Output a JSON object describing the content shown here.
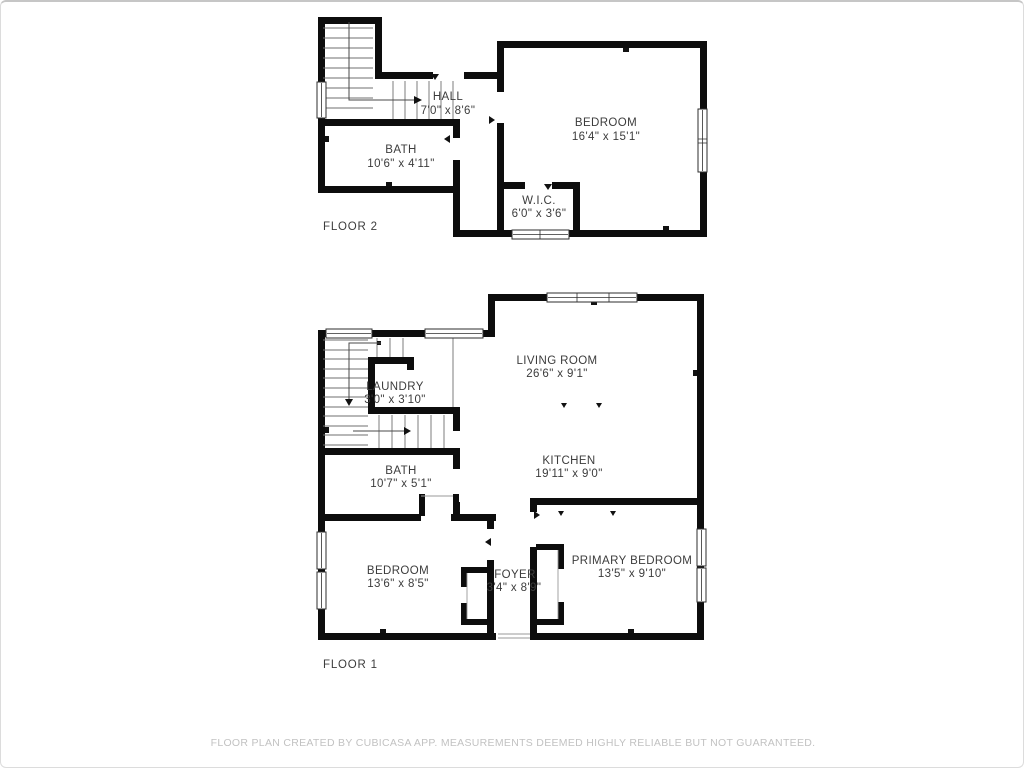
{
  "floor2": {
    "label": "FLOOR 2",
    "rooms": [
      {
        "name": "HALL",
        "dims": "7'0\" x 8'6\""
      },
      {
        "name": "BATH",
        "dims": "10'6\" x 4'11\""
      },
      {
        "name": "BEDROOM",
        "dims": "16'4\" x 15'1\""
      },
      {
        "name": "W.I.C.",
        "dims": "6'0\" x 3'6\""
      }
    ]
  },
  "floor1": {
    "label": "FLOOR 1",
    "rooms": [
      {
        "name": "LIVING ROOM",
        "dims": "26'6\" x 9'1\""
      },
      {
        "name": "LAUNDRY",
        "dims": "3'0\" x 3'10\""
      },
      {
        "name": "KITCHEN",
        "dims": "19'11\" x 9'0\""
      },
      {
        "name": "BATH",
        "dims": "10'7\" x 5'1\""
      },
      {
        "name": "BEDROOM",
        "dims": "13'6\" x 8'5\""
      },
      {
        "name": "FOYER",
        "dims": "3'4\" x 8'9\""
      },
      {
        "name": "PRIMARY BEDROOM",
        "dims": "13'5\" x 9'10\""
      }
    ]
  },
  "footer": {
    "disclaimer": "FLOOR PLAN CREATED BY CUBICASA APP. MEASUREMENTS DEEMED HIGHLY RELIABLE BUT NOT GUARANTEED."
  },
  "colors": {
    "wall": "#0d0d0d",
    "label_text": "#3c3c3c",
    "stair_line": "#6f6f6f",
    "disclaimer_text": "#c2c2c2",
    "background": "#ffffff"
  }
}
